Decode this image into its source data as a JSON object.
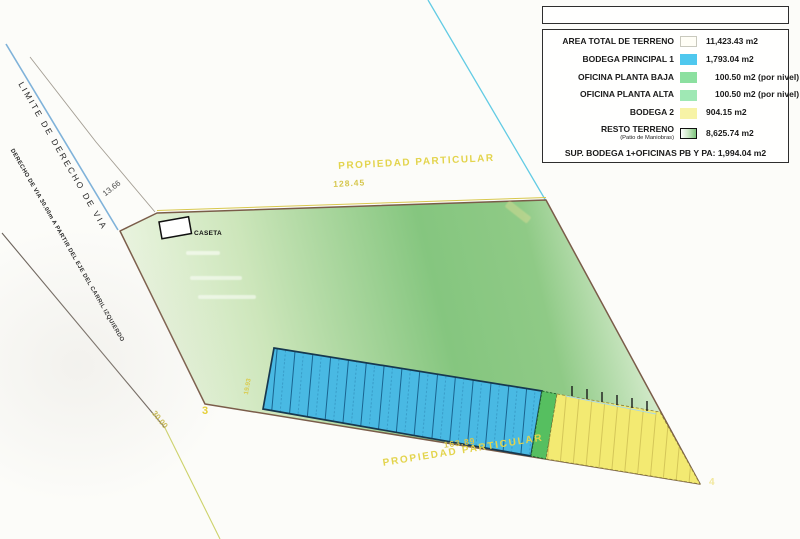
{
  "legend": {
    "title_box_text": "",
    "rows": [
      {
        "label": "AREA TOTAL DE TERRENO",
        "value": "11,423.43 m2",
        "swatch_color": "#fffef6"
      },
      {
        "label": "BODEGA PRINCIPAL 1",
        "value": "1,793.04 m2",
        "swatch_color": "#4fc8ee"
      },
      {
        "label": "OFICINA PLANTA BAJA",
        "value": "100.50 m2 (por nivel)",
        "swatch_color": "#8ce0a0"
      },
      {
        "label": "OFICINA PLANTA ALTA",
        "value": "100.50 m2 (por nivel)",
        "swatch_color": "#9fe8b4"
      },
      {
        "label": "BODEGA 2",
        "value": "904.15 m2",
        "swatch_color": "#f7f3a6"
      },
      {
        "label": "RESTO TERRENO",
        "sublabel": "(Patio de Maniobras)",
        "value": "8,625.74 m2",
        "swatch_color": "white-to-green-gradient"
      }
    ],
    "footer": "SUP. BODEGA 1+OFICINAS PB Y PA: 1,994.04 m2"
  },
  "plan": {
    "propiedad_top": "PROPIEDAD PARTICULAR",
    "dim_top": "128.45",
    "propiedad_bottom": "PROPIEDAD PARTICULAR",
    "dim_bottom": "163.89",
    "limite_label": "LIMITE DE DERECHO DE VIA",
    "derecho_label": "DERECHO DE VIA 30.00m A PARTIR DEL EJE DEL CARRIL IZQUIERDO",
    "dim_13": "13.66",
    "dim_30": "30.00",
    "dim_left_edge": "19.93",
    "caseta_label": "CASETA",
    "vertex_3": "3",
    "vertex_4": "4"
  },
  "colors": {
    "terrain_green": "#84c67e",
    "bodega1_cyan": "#49b9e3",
    "oficinas_green": "#56bf60",
    "bodega2_yellow": "#f3ea72",
    "boundary_brown": "#7a5c49",
    "limite_blue": "#7fb2d9",
    "label_yellow": "#e3d44d"
  }
}
